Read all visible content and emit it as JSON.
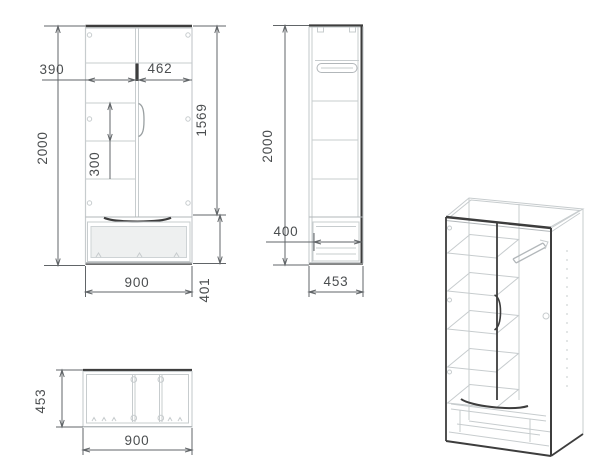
{
  "drawing": {
    "type": "furniture-technical-drawing",
    "subject": "two-door wardrobe with bottom drawer",
    "views": {
      "front": {
        "name": "front-view",
        "height": "2000",
        "left_section_width": "390",
        "right_section_width": "462",
        "shelf_spacing": "300",
        "door_section_height": "1569",
        "width": "900",
        "drawer_section_height": "401"
      },
      "side": {
        "name": "side-view",
        "height": "2000",
        "drawer_depth": "400",
        "depth": "453"
      },
      "top": {
        "name": "top-view",
        "depth": "453",
        "width": "900"
      },
      "isometric": {
        "name": "isometric-view"
      }
    },
    "colors": {
      "background": "#ffffff",
      "line_dark": "#3d3d3d",
      "line_light": "#c7ccce",
      "dimension_line": "#616568",
      "text": "#4b4e50"
    }
  }
}
